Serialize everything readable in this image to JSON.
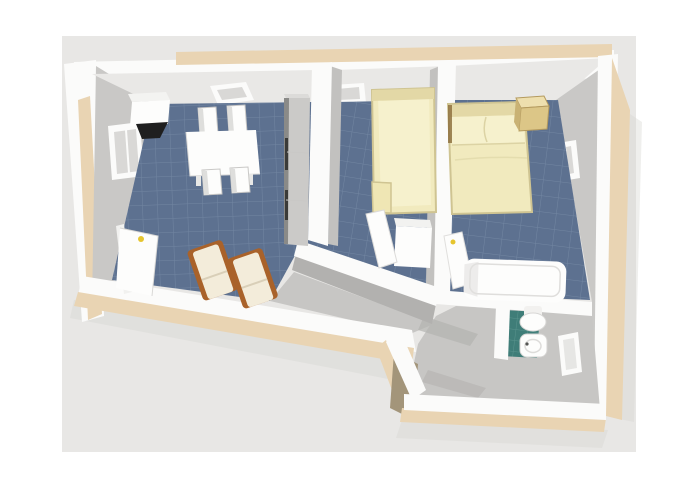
{
  "image": {
    "kind": "3d-floor-plan-render",
    "view": "birds-eye-perspective",
    "text_visible": "none"
  },
  "scene": {
    "rooms": [
      {
        "name": "living-dining-room",
        "floor": "blue-tile",
        "furniture": [
          "dining-table",
          "dining-chair-x4",
          "wall-cabinet",
          "tv",
          "tall-cabinet",
          "deck-chair-x2"
        ],
        "openings": [
          "window-left-wall",
          "window-top-wall",
          "entrance-door-open"
        ]
      },
      {
        "name": "bedroom-single",
        "floor": "blue-tile",
        "furniture": [
          "single-bed",
          "wardrobe",
          "wardrobe-door-open"
        ],
        "openings": [
          "window-top-wall"
        ]
      },
      {
        "name": "bedroom-double",
        "floor": "blue-tile",
        "furniture": [
          "double-bed",
          "nightstand",
          "door-open"
        ],
        "openings": [
          "window-right-wall"
        ]
      },
      {
        "name": "bathroom",
        "floor": "teal-tile-and-gray",
        "furniture": [
          "bathtub",
          "washbasin",
          "toilet"
        ],
        "openings": [
          "window-bottom-wall"
        ]
      },
      {
        "name": "hallway",
        "floor": "gray",
        "furniture": [],
        "openings": []
      }
    ]
  },
  "colors": {
    "page_bg": "#ffffff",
    "photo_bg": "#e8e7e5",
    "wall_white": "#fbfbfa",
    "wall_beige": "#e9d4b3",
    "wall_tan_dark": "#a3957a",
    "wall_face_light": "#e9e8e6",
    "wall_face_mid": "#c9c8c6",
    "wall_face_dark": "#b2b1af",
    "divider_face": "#c2c1bf",
    "floor_blue": "#5d7190",
    "grout_blue": "#8da0b8",
    "floor_teal": "#3f7d78",
    "grout_teal": "#6ea59e",
    "floor_gray": "#c7c6c4",
    "floor_shadow": "#b4b3b1",
    "window_inner": "#d9d8d6",
    "bed_cream": "#f1eabe",
    "bed_pillow": "#f6f1cd",
    "bed_head": "#e3d8a6",
    "nightstand_top": "#eedfae",
    "nightstand_front": "#dcc687",
    "nightstand_side": "#c9b274",
    "wood_brown": "#a9622a",
    "cushion_cream": "#f3ecda",
    "furniture_white": "#fdfdfc",
    "cabinet_gray": "#cbcac8",
    "cabinet_edge": "#8a8a88",
    "tv_black": "#1f1f1f",
    "handle_yellow": "#e6c52e",
    "shadow": "#d8d6d3"
  }
}
